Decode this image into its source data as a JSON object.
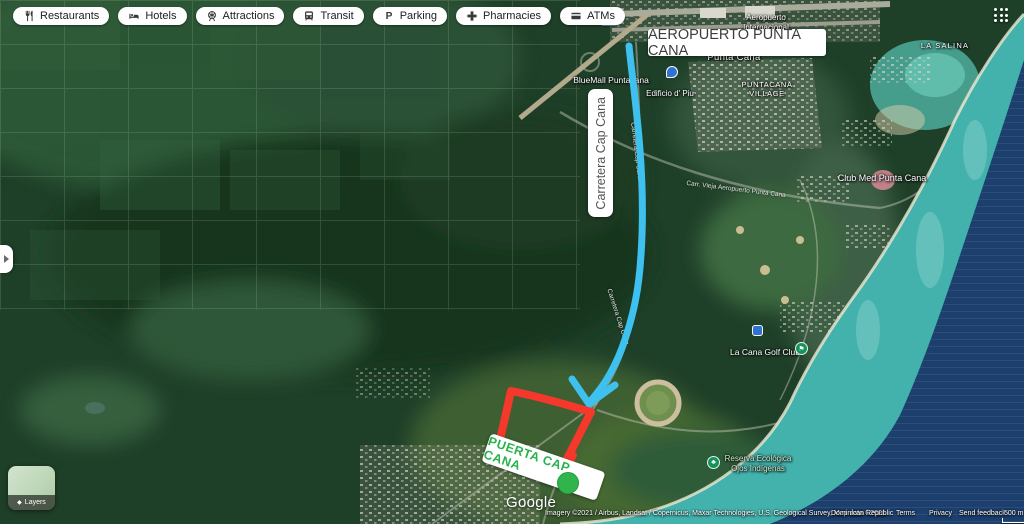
{
  "toolbar": {
    "items": [
      {
        "label": "Restaurants"
      },
      {
        "label": "Hotels"
      },
      {
        "label": "Attractions"
      },
      {
        "label": "Transit"
      },
      {
        "label": "Parking"
      },
      {
        "label": "Pharmacies"
      },
      {
        "label": "ATMs"
      }
    ]
  },
  "annotations": {
    "airport_box": "AEROPUERTO PUNTA CANA",
    "carretera_box": "Carretera Cap Cana",
    "puerta_box": "PUERTA CAP CANA",
    "colors": {
      "route_blue": "#3fc1f0",
      "rect_red": "#f4382b",
      "dot_green": "#2fb54b",
      "puerta_text": "#27b24b"
    }
  },
  "map_labels": {
    "airport_intl_line1": "Aeropuerto",
    "airport_intl_line2": "Internacional",
    "punta_cana": "Punta Cana",
    "bluemall": "BlueMall Puntacana",
    "edificio": "Edificio d' Piu",
    "village_line1": "PUNTACANA",
    "village_line2": "VILLAGE",
    "la_salina": "LA SALINA",
    "club_med": "Club Med Punta Cana",
    "road_diagonal": "Carr. Vieja Aeropuerto Punta Cana",
    "road_vertical": "Carretera Cap Cana",
    "road_vertical2": "Carretera Cap Cana",
    "la_cana_golf": "La Cana Golf Club",
    "reserva_line1": "Reserva Ecológica",
    "reserva_line2": "Ojos Indígenas",
    "route_shield": "106"
  },
  "icons": {
    "golf_icon": "⚑",
    "tree_icon": "♣",
    "layers_icon": "◆",
    "bluemall_pin": "●",
    "store_pin": "●"
  },
  "controls": {
    "layers_label": "Layers"
  },
  "footer": {
    "logo": "Google",
    "attribution": "Imagery ©2021 / Airbus, Landsat / Copernicus, Maxar Technologies, U.S. Geological Survey, Map data ©2021",
    "region": "Dominican Republic",
    "terms": "Terms",
    "privacy": "Privacy",
    "feedback": "Send feedback",
    "scale": "500 m"
  }
}
